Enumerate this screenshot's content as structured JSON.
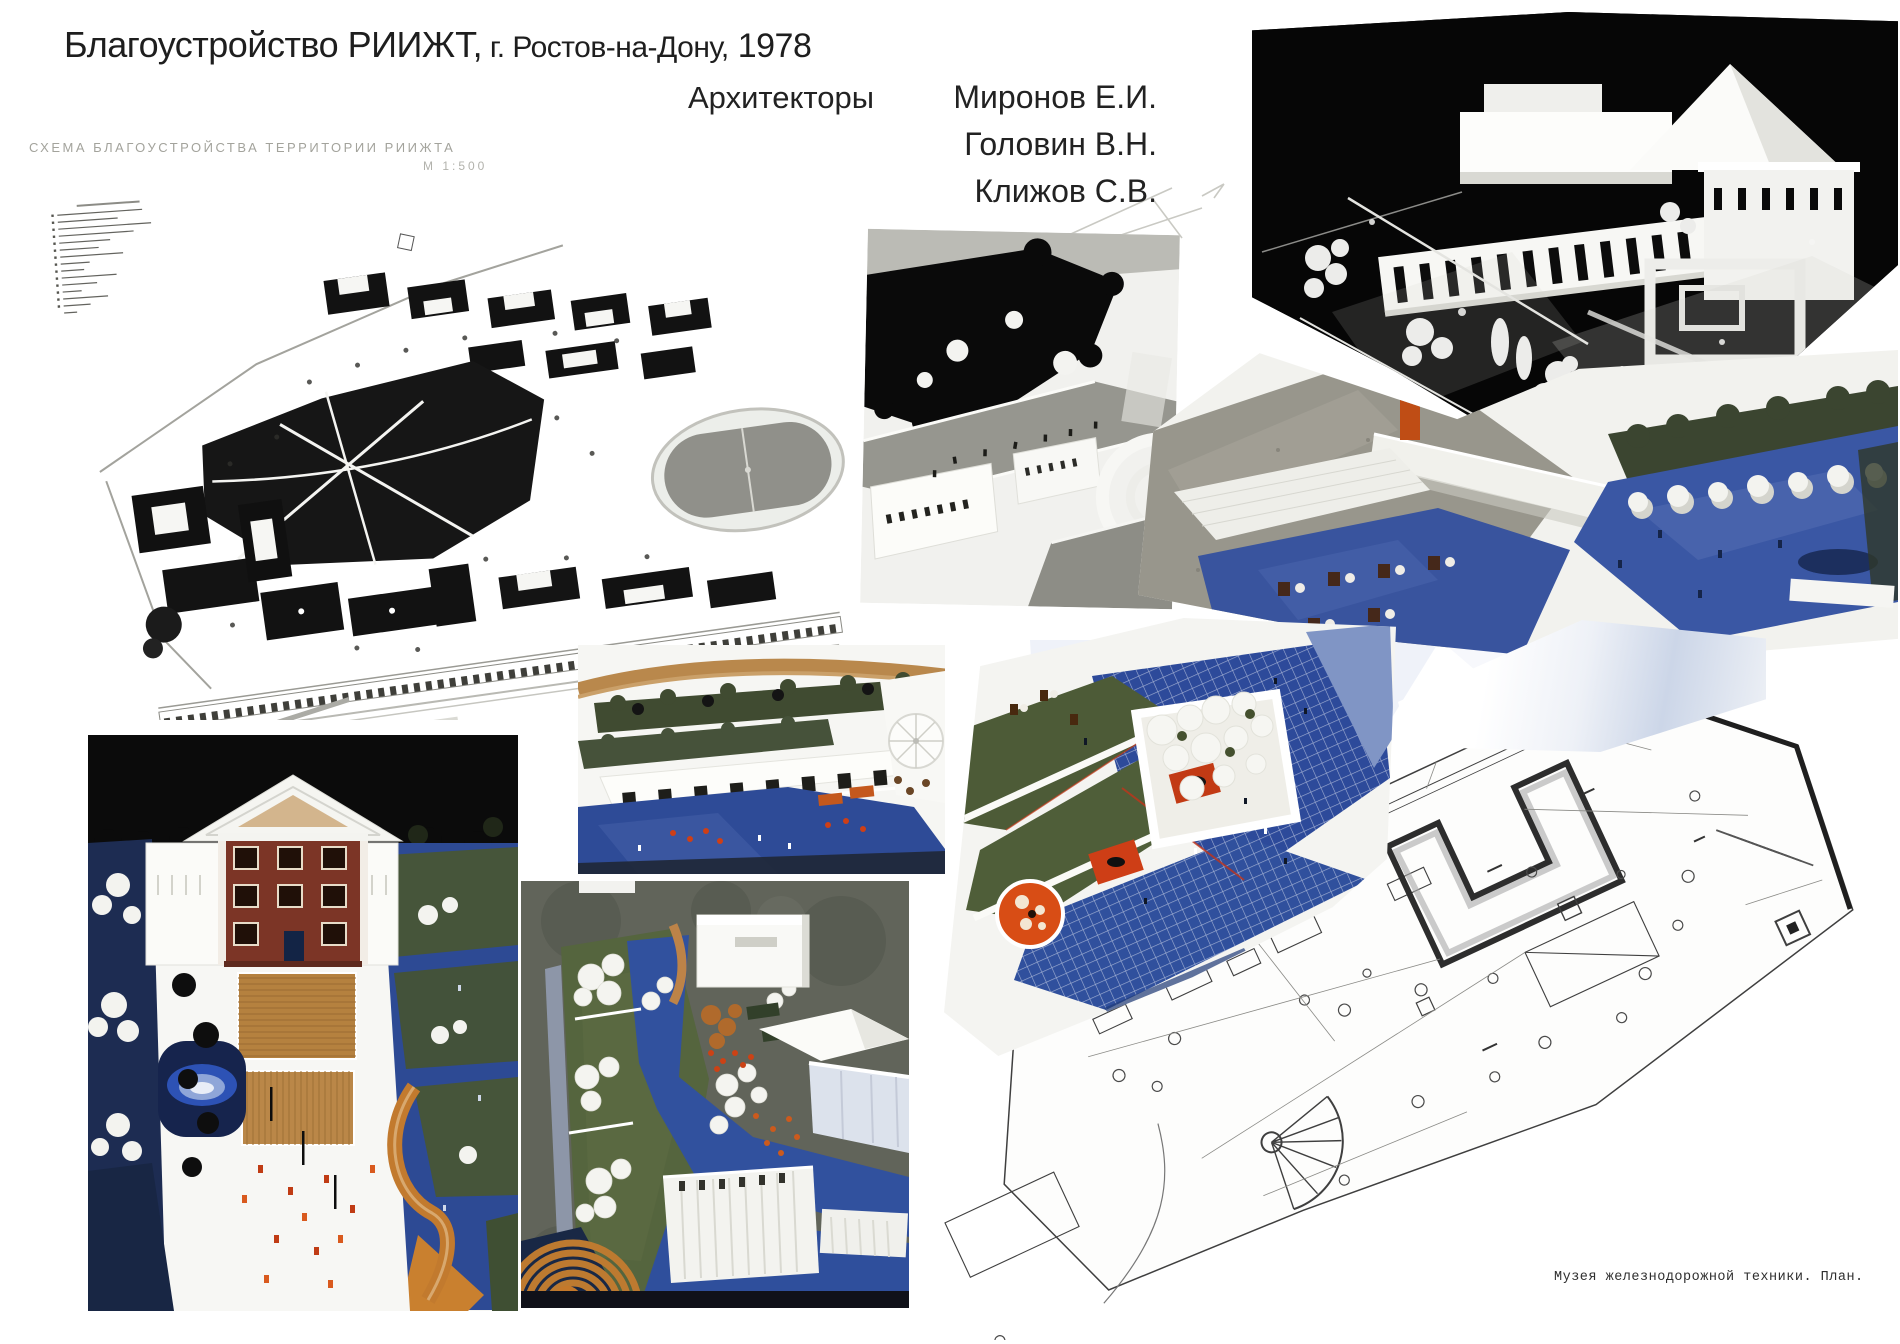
{
  "header": {
    "title_main": "Благоустройство РИИЖТ,",
    "title_city": " г. Ростов-на-Дону,",
    "title_year": " 1978",
    "architects_label": "Архитекторы",
    "architects": [
      "Миронов Е.И.",
      "Головин В.Н.",
      "Клижов С.В."
    ]
  },
  "site_plan": {
    "heading": "СХЕМА БЛАГОУСТРОЙСТВА ТЕРРИТОРИИ РИИЖТА",
    "scale": "М 1:500"
  },
  "museum_plan": {
    "caption": "Музея железнодорожной техники. План."
  },
  "colors": {
    "plaza_blue": "#2e4b9b",
    "navy_dark": "#1c2b52",
    "lawn_green": "#4e5c38",
    "accent_orange": "#c9571c",
    "kiosk_red": "#d84d15",
    "brick_red": "#7c3526",
    "deck_tan": "#b5813f",
    "asphalt_gray": "#62655a",
    "photo_black": "#070707",
    "plan_line": "#3f3f3f"
  }
}
